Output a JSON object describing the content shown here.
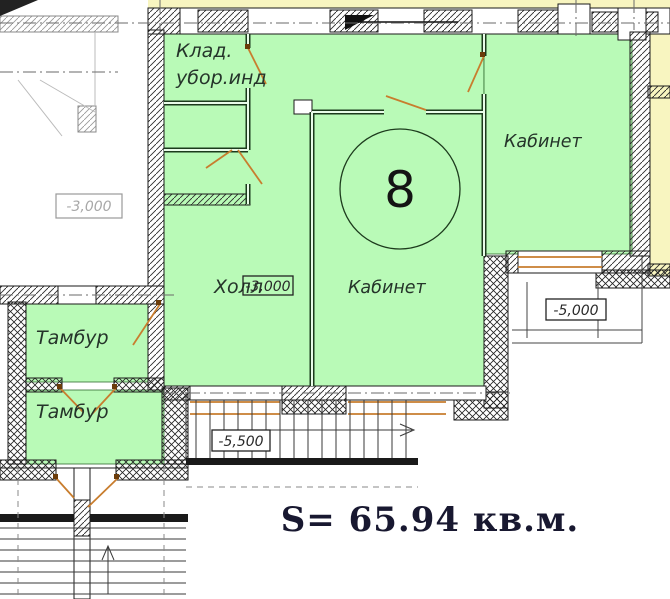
{
  "plan": {
    "apartment_number": "8",
    "area_text": "S= 65.94 кв.м.",
    "rooms": {
      "klad": "Клад.",
      "ubor": "убор.инд",
      "kabinet_right": "Кабинет",
      "kabinet_center": "Кабинет",
      "holl": "Холл",
      "tambur_upper": "Тамбур",
      "tambur_lower": "Тамбур"
    },
    "elevations": {
      "left_unit": "-3,000",
      "holl": "-3,000",
      "terrace": "-5,000",
      "stairs": "-5,500"
    },
    "colors": {
      "room_fill": "#b9fab7",
      "adjacent_fill": "#f8f5c0",
      "door_color": "#c87d2e",
      "hinge_color": "#6b3c0a",
      "wall_color": "#1a1a1a",
      "area_text_color": "#181830"
    }
  }
}
